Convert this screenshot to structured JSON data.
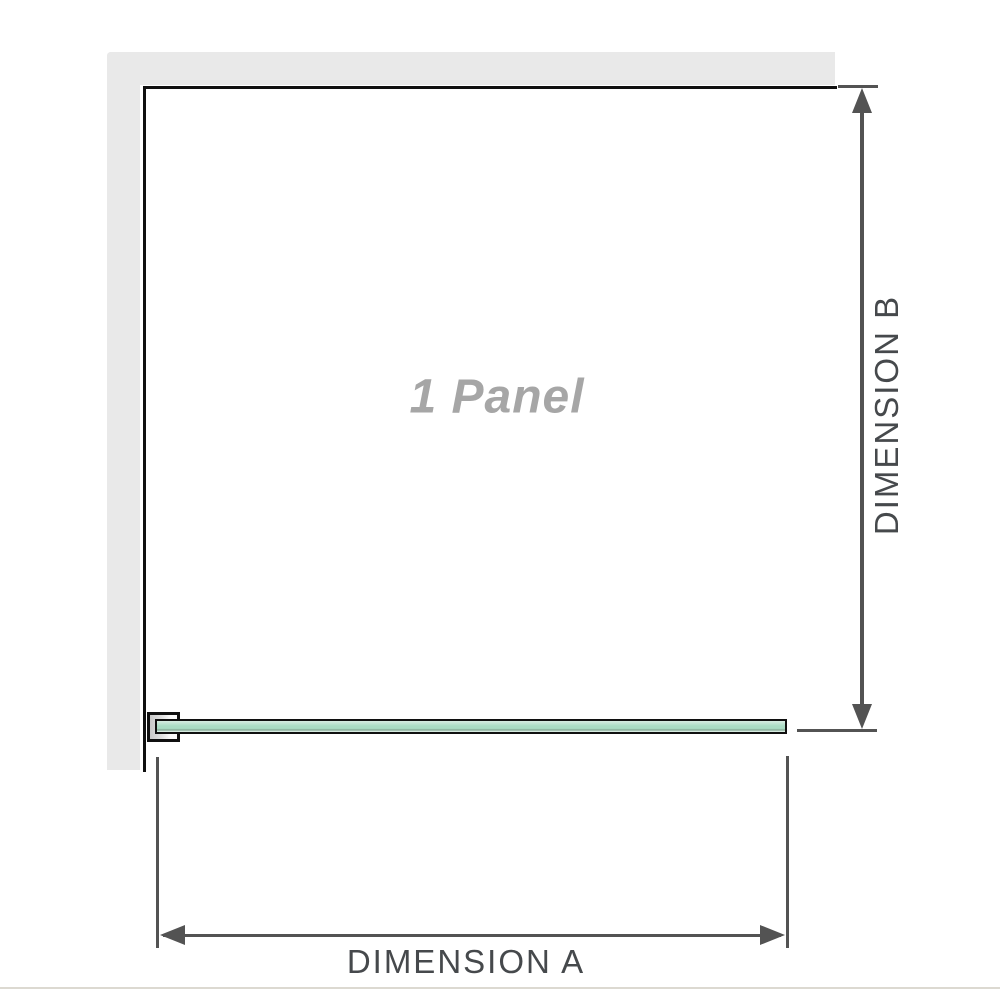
{
  "diagram": {
    "panel_label": "1 Panel",
    "dimension_a_label": "DIMENSION A",
    "dimension_b_label": "DIMENSION B"
  },
  "colors": {
    "wall": "#e9e9e9",
    "outline": "#101010",
    "dimension_line": "#535353",
    "label_text": "#46494c",
    "panel_label_text": "#a6a6a6",
    "glass_light": "#d8ece2",
    "glass_mid": "#aadcc4",
    "glass_dark": "#84a794",
    "bracket_fill": "#c8c8c8",
    "separator": "#dcd9d1"
  }
}
